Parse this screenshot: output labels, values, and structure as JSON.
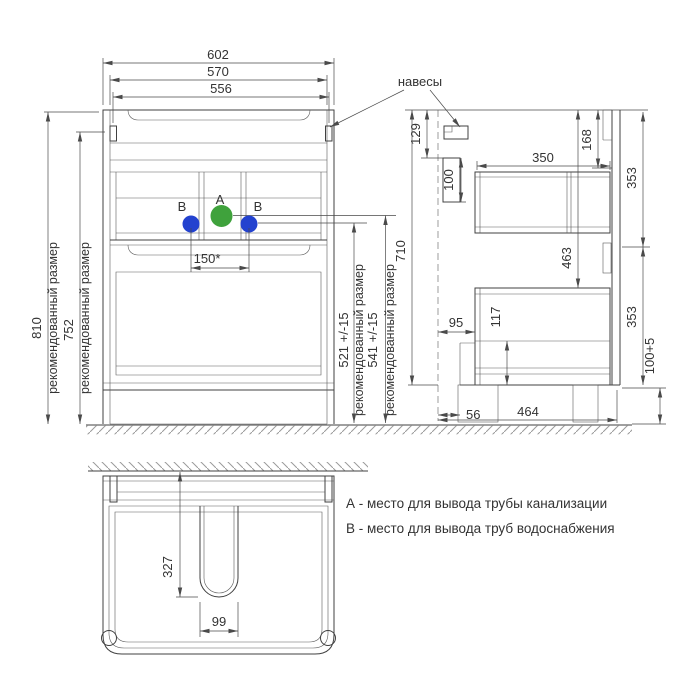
{
  "drawing": {
    "dims_front": {
      "w602": "602",
      "w570": "570",
      "w556": "556",
      "h810": "810",
      "h752": "752",
      "h521": "521 +/-15",
      "h541": "541 +/-15",
      "d150": "150*"
    },
    "dims_side": {
      "h710": "710",
      "d129": "129",
      "d100": "100",
      "d350": "350",
      "d168": "168",
      "d353_top": "353",
      "d463": "463",
      "d353_bottom": "353",
      "d95": "95",
      "d117": "117",
      "d56": "56",
      "d464": "464",
      "h100_5": "100+5"
    },
    "dims_bottom": {
      "d327": "327",
      "d99": "99"
    },
    "labels": {
      "recommended": "рекомендованный размер",
      "hangers": "навесы",
      "point_a": "A",
      "point_b": "B"
    },
    "legend": {
      "a": "А - место для вывода трубы канализации",
      "b": "В - место для вывода труб водоснабжения"
    },
    "colors": {
      "outlet_a": "#3fa23c",
      "outlet_b": "#2342cf",
      "line": "#414141"
    }
  }
}
